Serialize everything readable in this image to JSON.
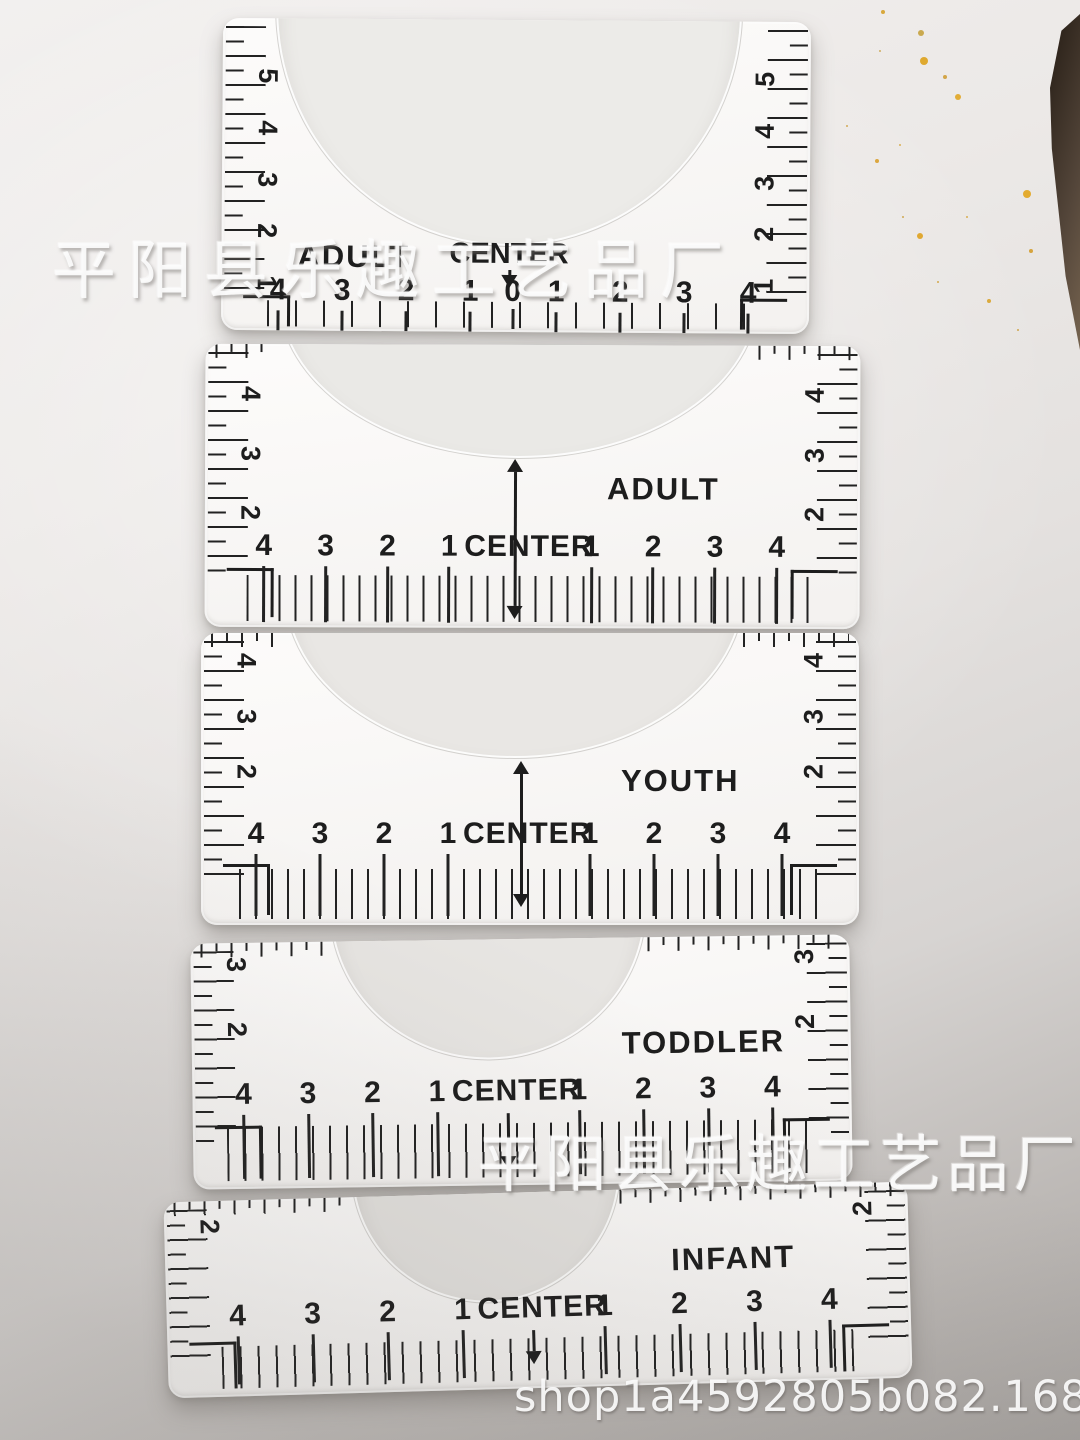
{
  "watermarks": {
    "factory_name_top": "平阳县乐趣工艺品厂",
    "factory_name_middle": "平阳县乐趣工艺品厂",
    "shop_url": "shop1a4592805b082.1688.com"
  },
  "colors": {
    "background_light": "#f2f0ef",
    "background_dark": "#a5a19e",
    "ruler_plate": "#faf9f8",
    "ink": "#1d1d1d",
    "watermark": "#fcfcfc",
    "speckle_gold": "#dfa72f",
    "corner_object_brown": "#54463a"
  },
  "rulers": [
    {
      "size_label": "ADULT",
      "center_label": "CENTER",
      "center_cell": "0",
      "left_scale": [
        "5",
        "4",
        "3",
        "2",
        "1"
      ],
      "right_scale": [
        "5",
        "4",
        "3",
        "2",
        "1"
      ],
      "left_numbers": [
        "4",
        "3",
        "2",
        "1"
      ],
      "right_numbers": [
        "1",
        "2",
        "3",
        "4"
      ]
    },
    {
      "size_label": "ADULT",
      "center_cell": "CENTER",
      "left_scale": [
        "4",
        "3",
        "2"
      ],
      "right_scale": [
        "4",
        "3",
        "2"
      ],
      "left_numbers": [
        "4",
        "3",
        "2",
        "1"
      ],
      "right_numbers": [
        "1",
        "2",
        "3",
        "4"
      ]
    },
    {
      "size_label": "YOUTH",
      "center_cell": "CENTER",
      "left_scale": [
        "4",
        "3",
        "2"
      ],
      "right_scale": [
        "4",
        "3",
        "2"
      ],
      "left_numbers": [
        "4",
        "3",
        "2",
        "1"
      ],
      "right_numbers": [
        "1",
        "2",
        "3",
        "4"
      ]
    },
    {
      "size_label": "TODDLER",
      "center_cell": "CENTER",
      "left_scale": [
        "3",
        "2"
      ],
      "right_scale": [
        "3",
        "2"
      ],
      "left_numbers": [
        "4",
        "3",
        "2",
        "1"
      ],
      "right_numbers": [
        "1",
        "2",
        "3",
        "4"
      ]
    },
    {
      "size_label": "INFANT",
      "center_cell": "CENTER",
      "left_scale": [
        "2"
      ],
      "right_scale": [
        "2"
      ],
      "left_numbers": [
        "4",
        "3",
        "2",
        "1"
      ],
      "right_numbers": [
        "1",
        "2",
        "3",
        "4"
      ]
    }
  ]
}
